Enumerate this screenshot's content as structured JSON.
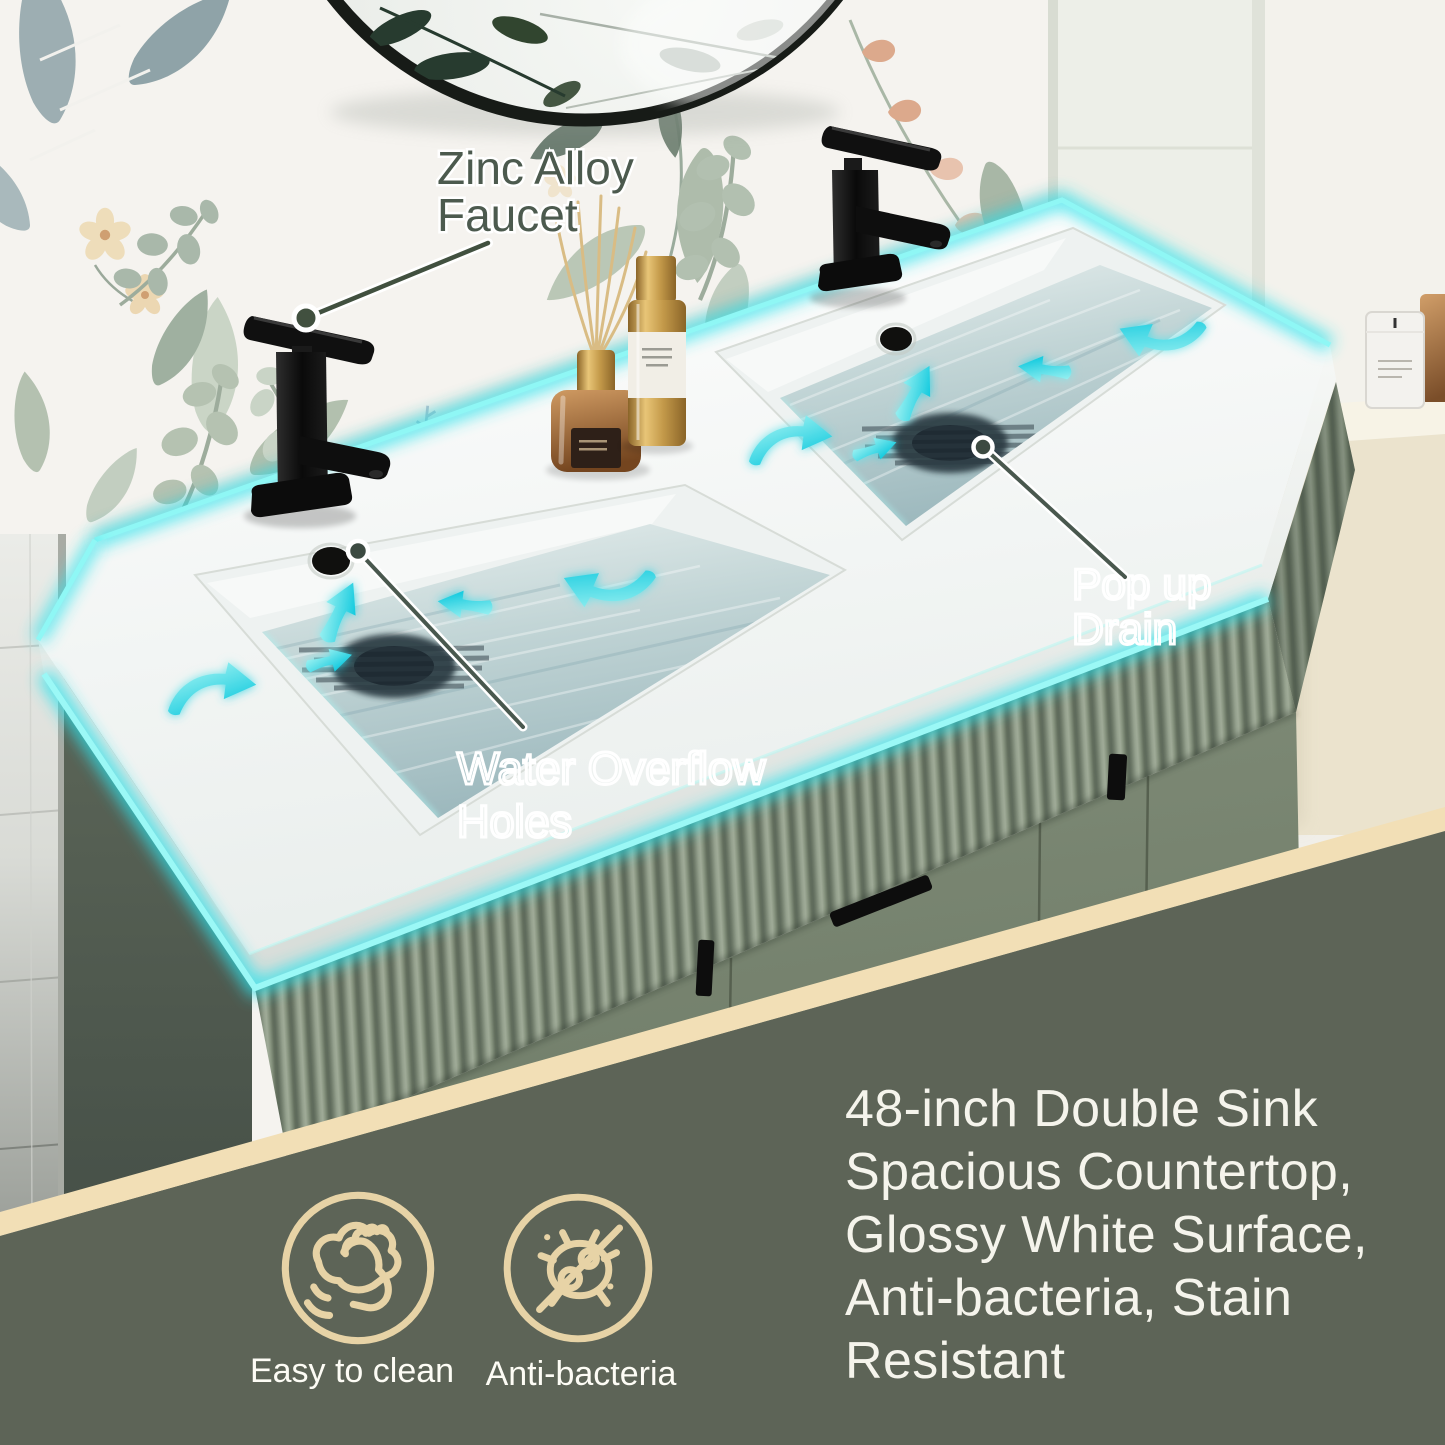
{
  "callouts": {
    "faucet": {
      "lines": [
        "Zinc Alloy",
        "Faucet"
      ]
    },
    "overflow": {
      "lines": [
        "Water Overflow",
        "Holes"
      ]
    },
    "drain": {
      "lines": [
        "Pop up",
        "Drain"
      ]
    }
  },
  "features": {
    "lines": [
      "48-inch Double Sink",
      "Spacious Countertop,",
      "Glossy White Surface,",
      "Anti-bacteria, Stain",
      "Resistant"
    ]
  },
  "badges": [
    {
      "icon": "wipe-clean-icon",
      "label": "Easy to clean"
    },
    {
      "icon": "no-bacteria-icon",
      "label": "Anti-bacteria"
    }
  ],
  "colors": {
    "overlay_green": "#5d6457",
    "ribbon_cream": "#f2dfb6",
    "badge_icon_tan": "#e7d3a6",
    "glow_cyan": "#3fe2ea",
    "feature_text": "#f5f4ec",
    "callout_green": "#4c5a4e",
    "cabinet_green": "#7b8773",
    "counter_white": "#f7f9f7",
    "water_blue": "#aac4c8",
    "faucet_black": "#141414"
  }
}
